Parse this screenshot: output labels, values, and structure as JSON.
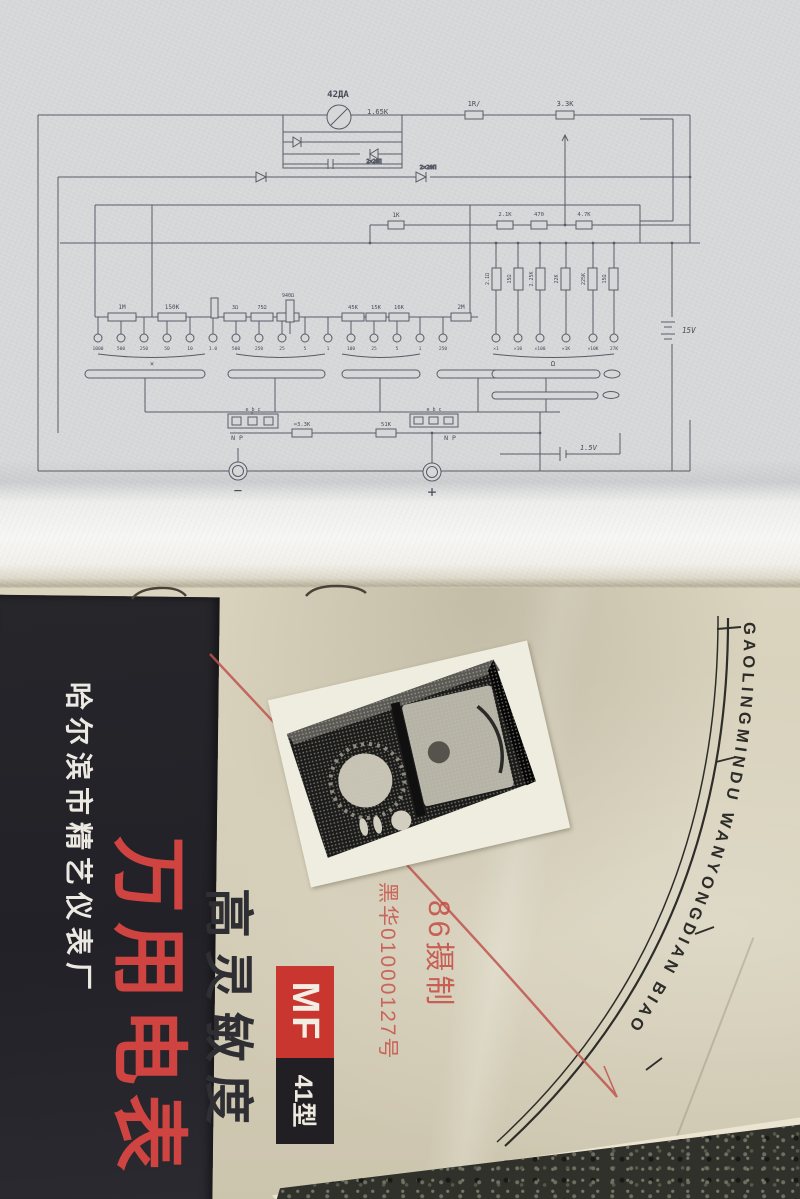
{
  "schematic": {
    "meter": {
      "type_label": "42ДА",
      "coil_value": "1.65K"
    },
    "diode_label_box": "2×2ФП",
    "diode_label_line": "2×2ФП",
    "resistors_top": {
      "r1": "1R/",
      "r2": "3.3K"
    },
    "resistors_mid": {
      "r1": "1K",
      "r2": "2.1K",
      "r3": "470",
      "r4": "4.7K"
    },
    "range_resistors": [
      "1M",
      "150K",
      "3Ω",
      "75Ω",
      "940Ω",
      "45K",
      "15K",
      "16K",
      "2M"
    ],
    "shunt_resistors": [
      "2.1Ω",
      "15Ω",
      "2.25K",
      "22K",
      "225K",
      "15Ω"
    ],
    "contact_labels": [
      "1000",
      "500",
      "250",
      "50",
      "10",
      "1.0",
      "500",
      "250",
      "25",
      "5",
      "1",
      "100",
      "25",
      "5",
      "1",
      "250"
    ],
    "ohm_contact_labels": [
      "×1",
      "×10",
      "×100",
      "×1K",
      "×10K",
      "27K"
    ],
    "group_labels": {
      "left": "×",
      "ohm": "Ω"
    },
    "batteries": {
      "top": "15V",
      "bottom": "1.5V"
    },
    "sockets": {
      "pins": "e b c",
      "left_label": "N P",
      "right_label": "N P",
      "r1_label": "≈3.3K",
      "r2_label": "51K"
    },
    "terminals": {
      "minus": "−",
      "plus": "+"
    }
  },
  "cover": {
    "factory_name": "哈尔滨市精艺仪表厂",
    "title": "万用电表",
    "subtitle": "高灵敏度",
    "model_prefix": "MF",
    "model_suffix": "41型",
    "arc_text": "GAOLINGMINDU  WANYONGDIAN  BIAO",
    "stamp_line1": "86摄制",
    "stamp_line2": "黑华01000127号"
  },
  "colors": {
    "accent_red": "#cf4440",
    "stamp_red": "#c44b43",
    "band_black": "#26262b",
    "cover_paper": "#d6cfb8",
    "page_paper": "#d6d7d9",
    "ink": "#585c66"
  }
}
